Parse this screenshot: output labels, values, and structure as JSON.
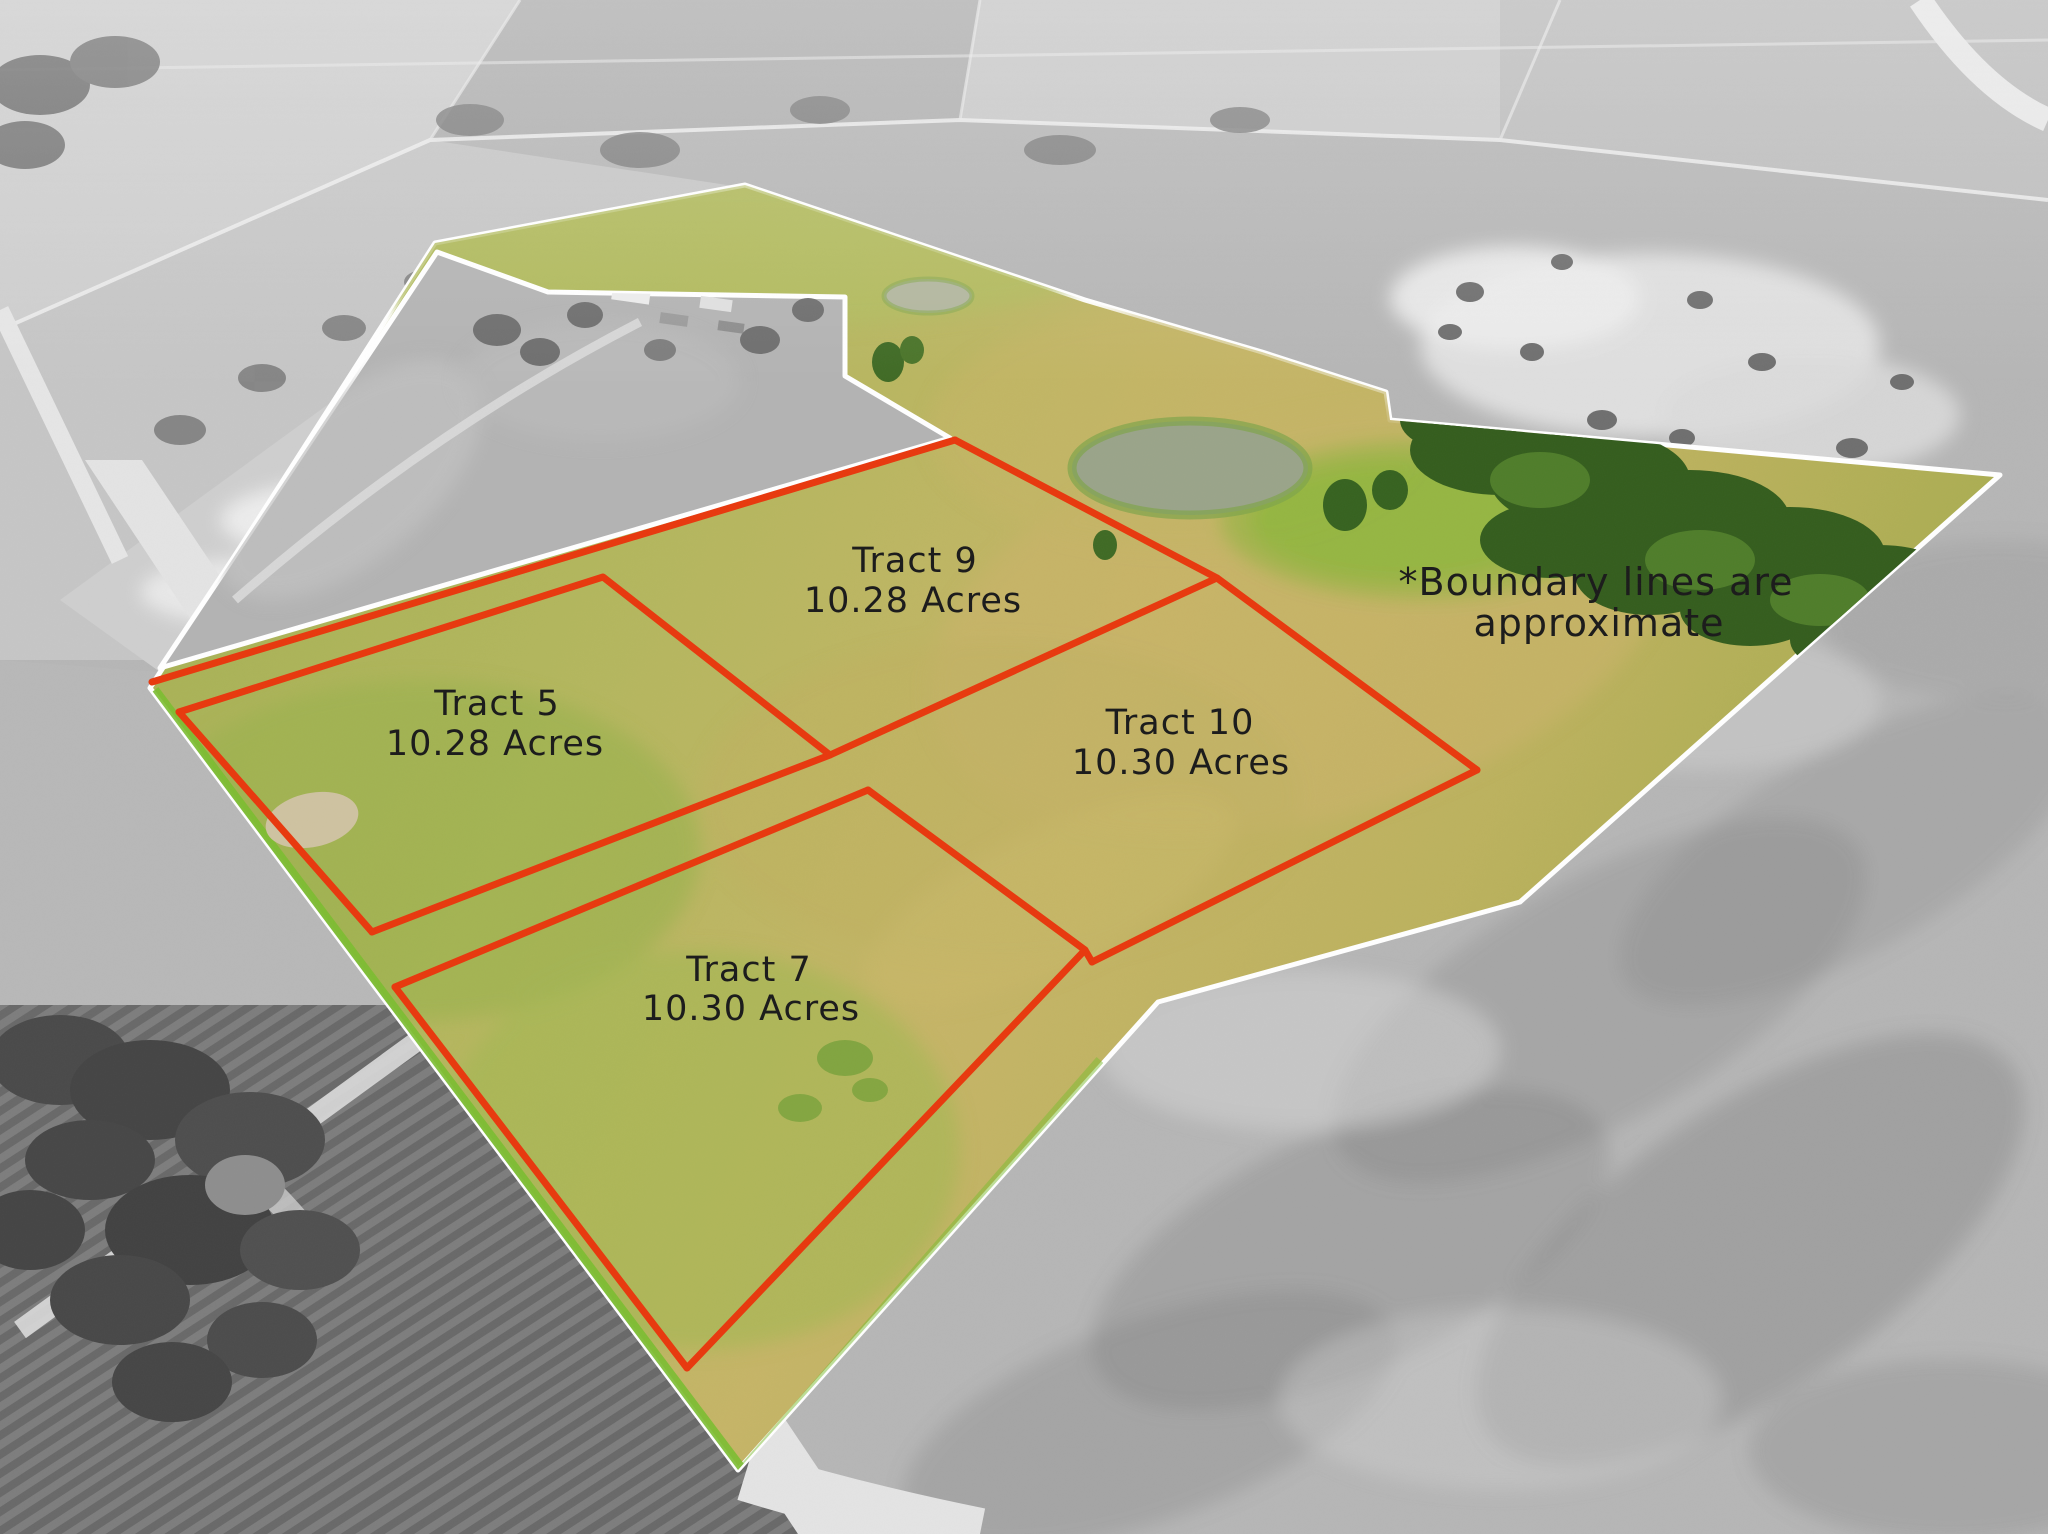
{
  "map": {
    "title": "Aerial tract map with highlighted property",
    "note": {
      "line1": "*Boundary lines are",
      "line2": "approximate"
    },
    "tracts": [
      {
        "id": "tract-9",
        "name": "Tract 9",
        "acres": "10.28 Acres"
      },
      {
        "id": "tract-5",
        "name": "Tract 5",
        "acres": "10.28 Acres"
      },
      {
        "id": "tract-10",
        "name": "Tract 10",
        "acres": "10.30 Acres"
      },
      {
        "id": "tract-7",
        "name": "Tract 7",
        "acres": "10.30 Acres"
      }
    ],
    "colors": {
      "tract_boundary_red": "#e8380d",
      "property_outline_white": "#ffffff",
      "highlighted_land_green": "#aeb85c",
      "road_green_strip": "#7cbe31",
      "label_text": "#1a1a1a"
    }
  }
}
